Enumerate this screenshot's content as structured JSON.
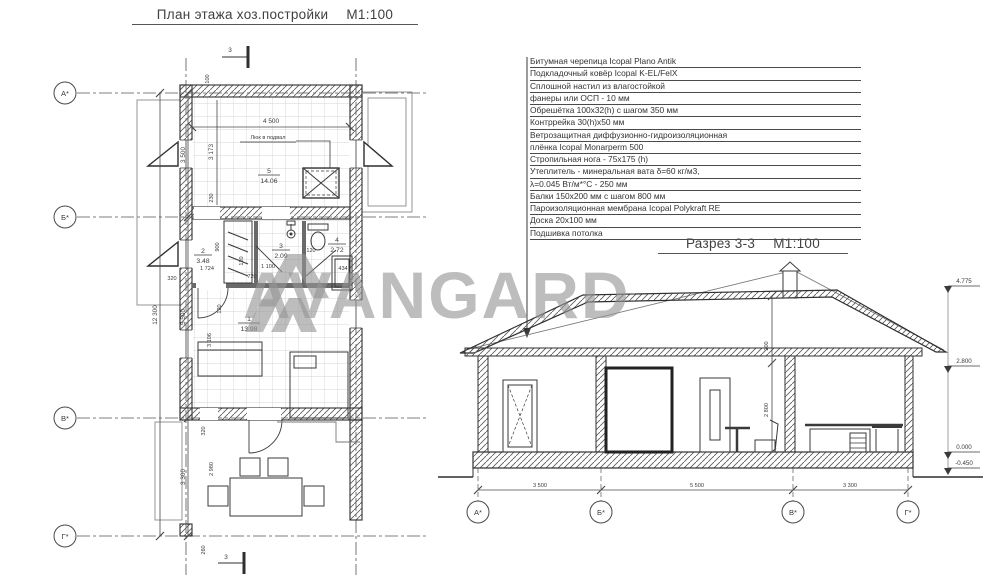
{
  "plan": {
    "title": "План этажа хоз.постройки",
    "scale": "М1:100",
    "axes": [
      "А*",
      "Б*",
      "В*",
      "Г*"
    ],
    "section_mark": "3",
    "dims": {
      "overall": "12 300",
      "ab": "3 500",
      "bv": "5 500",
      "vg": "3 300",
      "room5_w": "4 500",
      "room5_h": "3 173",
      "off100": "100",
      "off230": "230",
      "hall_w": "1 724",
      "hall_h": "900",
      "off320": "320",
      "d1100": "1 100",
      "d720": "720",
      "d120a": "120",
      "d120b": "120",
      "wc_w": "434",
      "living_h": "3 106",
      "living_off": "120",
      "terr_off": "320",
      "terr_h": "2 980",
      "d260": "260"
    },
    "rooms": {
      "r1": {
        "num": "1",
        "area": "13.98"
      },
      "r2": {
        "num": "2",
        "area": "3.48"
      },
      "r3": {
        "num": "3",
        "area": "2.09"
      },
      "r4": {
        "num": "4",
        "area": "2.72"
      },
      "r5": {
        "num": "5",
        "area": "14.06"
      }
    },
    "labels": {
      "hatch_note": "Люк в подвал"
    }
  },
  "spec": {
    "items": [
      "Битумная черепица  Icopal Plano Antik",
      "Подкладочный ковёр Icopal K-EL/FelX",
      "Сплошной настил из влагостойкой",
      "фанеры или ОСП - 10 мм",
      "Обрешётка 100х32(h) с шагом 350 мм",
      "Контррейка 30(h)х50 мм",
      "Ветрозащитная диффузионно-гидроизоляционная",
      "плёнка Icopal Monarperm 500",
      "Стропильная нога - 75х175 (h)",
      "Утеплитель - минеральная вата δ=60 кг/м3,",
      "λ=0.045 Вт/м*°С - 250 мм",
      "Балки 150х200 мм с шагом 800 мм",
      "Пароизоляционная мембрана Icopal Polykraft RE",
      "Доска 20х100 мм",
      "Подшивка потолка"
    ]
  },
  "section": {
    "title": "Разрез 3-3",
    "scale": "М1:100",
    "axes": [
      "А*",
      "Б*",
      "В*",
      "Г*"
    ],
    "dims_bottom": [
      "3 500",
      "5 500",
      "3 300"
    ],
    "elevations": [
      "4.775",
      "2.800",
      "0.000",
      "-0.450"
    ],
    "d200": "200",
    "d2800": "2 800"
  },
  "watermark": {
    "text": "AVANGARD"
  },
  "colors": {
    "line": "#3a3a3a",
    "hatch": "#5f5f5f",
    "tile": "#c9c9c9",
    "watermark": "#949494"
  }
}
